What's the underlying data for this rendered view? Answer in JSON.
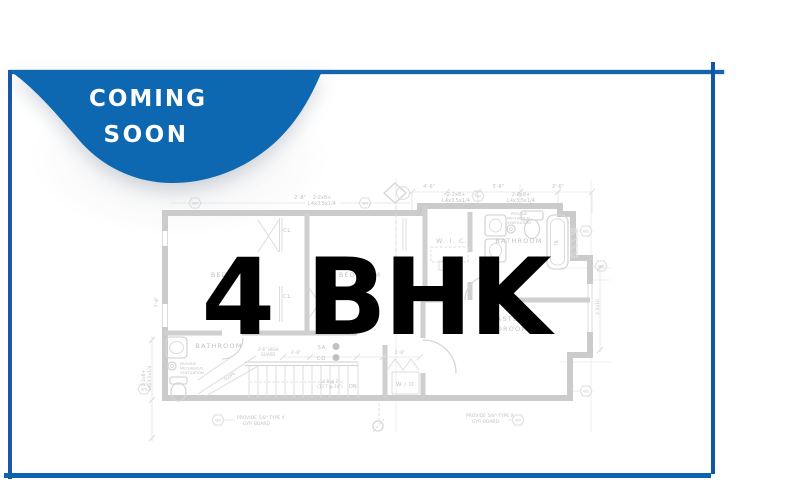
{
  "badge": {
    "line1": "COMING",
    "line2": "SOON"
  },
  "headline": {
    "text": "4 BHK"
  },
  "colors": {
    "badge_blue": "#0d68b1",
    "frame_blue": "#1565ae",
    "plan_gray": "#cbcbcb",
    "headline_black": "#000000"
  },
  "plan": {
    "rooms": {
      "bedroom_left": "BEDROOM",
      "bedroom_mid": "BEDROOM",
      "wic": "W. I. C.",
      "bathroom_top": "BATHROOM",
      "master_line1": "MASTER",
      "master_line2": "BEDROOM",
      "bathroom_bottom": "BATHROOM",
      "wd": "W / D",
      "closet": "CL"
    },
    "marks": {
      "w3": "W3",
      "sa": "SA",
      "co": "CO",
      "dn": "DN",
      "slope": "SLOPE",
      "tub": "TB",
      "beam_line1": "2-2x8+",
      "beam_line2": "L4x3.5x1/4",
      "joist": "2-2x10",
      "dim_36": "3'-6\"",
      "dim_46": "4'-6\"",
      "dim_26": "2'-6\"",
      "dim_28": "2'-8\"",
      "dim_76": "7'-6\"",
      "guard1": "3'-6\" HIGH",
      "guard2": "GUARD",
      "stairs1": "14 R @ 7\"",
      "stairs2": "(13 T @ 10\")",
      "vent1": "PROVIDE",
      "vent2": "MECHANICAL",
      "vent3": "VENTILATION",
      "gyp1": "PROVIDE 5/8\" TYPE X",
      "gyp2": "GYP. BOARD"
    }
  }
}
